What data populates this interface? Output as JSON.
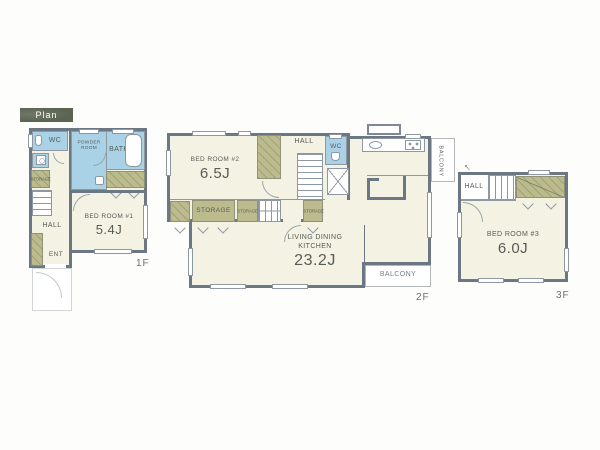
{
  "badge": {
    "label": "Plan"
  },
  "colors": {
    "wall": "#6b7883",
    "room_floor": "#f4f2e3",
    "wet_room": "#a9d2e6",
    "closet": "#bcbb8d",
    "badge_background": "#5b6351",
    "label_text": "#565c56"
  },
  "floor_1": {
    "label": "1F",
    "rooms": {
      "wc": "WC",
      "powder_room": "POWDER ROOM",
      "bath": "BATH",
      "storage": "STORAGE",
      "hall": "HALL",
      "entrance": "ENT",
      "bedroom": "BED ROOM #1",
      "bedroom_size": "5.4J"
    }
  },
  "floor_2": {
    "label": "2F",
    "rooms": {
      "bedroom": "BED ROOM #2",
      "bedroom_size": "6.5J",
      "hall": "HALL",
      "wc": "WC",
      "storage_large": "STORAGE",
      "storage_small_a": "STORAGE",
      "storage_small_b": "STORAGE",
      "ldk_line1": "LIVING DINING",
      "ldk_line2": "KITCHEN",
      "ldk_size": "23.2J",
      "balcony_side": "BALCONY",
      "balcony_rear": "BALCONY"
    }
  },
  "floor_3": {
    "label": "3F",
    "rooms": {
      "hall": "HALL",
      "bedroom": "BED ROOM #3",
      "bedroom_size": "6.0J"
    }
  }
}
